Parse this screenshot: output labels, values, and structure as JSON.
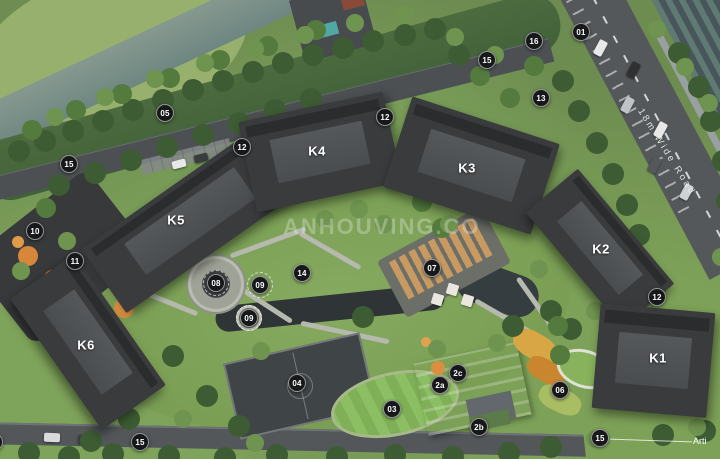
{
  "plan": {
    "watermark": "ANHOUVING.CO",
    "road_label": "18m Wide Road",
    "edge_label": "Arti",
    "colors": {
      "marker_background": "#17181a",
      "marker_text": "#ffffff",
      "building_label_text": "#ffffff",
      "building_roof": "#393b3d",
      "road": "#54585a",
      "water": "#6e8681"
    },
    "buildings": [
      {
        "label": "K5",
        "x": 176,
        "y": 220
      },
      {
        "label": "K4",
        "x": 317,
        "y": 151
      },
      {
        "label": "K3",
        "x": 467,
        "y": 168
      },
      {
        "label": "K2",
        "x": 601,
        "y": 249
      },
      {
        "label": "K1",
        "x": 658,
        "y": 358
      },
      {
        "label": "K6",
        "x": 86,
        "y": 345
      }
    ],
    "markers": [
      {
        "label": "01",
        "x": 581,
        "y": 32
      },
      {
        "label": "16",
        "x": 534,
        "y": 41
      },
      {
        "label": "15",
        "x": 487,
        "y": 60
      },
      {
        "label": "13",
        "x": 541,
        "y": 98
      },
      {
        "label": "12",
        "x": 385,
        "y": 117
      },
      {
        "label": "05",
        "x": 165,
        "y": 113
      },
      {
        "label": "12",
        "x": 242,
        "y": 147
      },
      {
        "label": "15",
        "x": 69,
        "y": 164
      },
      {
        "label": "10",
        "x": 35,
        "y": 231
      },
      {
        "label": "11",
        "x": 75,
        "y": 261
      },
      {
        "label": "08",
        "x": 216,
        "y": 283,
        "ring": true
      },
      {
        "label": "09",
        "x": 260,
        "y": 285,
        "ring": true
      },
      {
        "label": "14",
        "x": 302,
        "y": 273
      },
      {
        "label": "09",
        "x": 249,
        "y": 318,
        "ring": true
      },
      {
        "label": "07",
        "x": 432,
        "y": 268
      },
      {
        "label": "12",
        "x": 657,
        "y": 297
      },
      {
        "label": "06",
        "x": 560,
        "y": 390
      },
      {
        "label": "04",
        "x": 297,
        "y": 383
      },
      {
        "label": "03",
        "x": 392,
        "y": 409
      },
      {
        "label": "2a",
        "x": 440,
        "y": 385
      },
      {
        "label": "2c",
        "x": 458,
        "y": 373
      },
      {
        "label": "2b",
        "x": 479,
        "y": 427
      },
      {
        "label": "01",
        "x": -6,
        "y": 442
      },
      {
        "label": "15",
        "x": 140,
        "y": 442
      },
      {
        "label": "15",
        "x": 600,
        "y": 438
      }
    ]
  }
}
